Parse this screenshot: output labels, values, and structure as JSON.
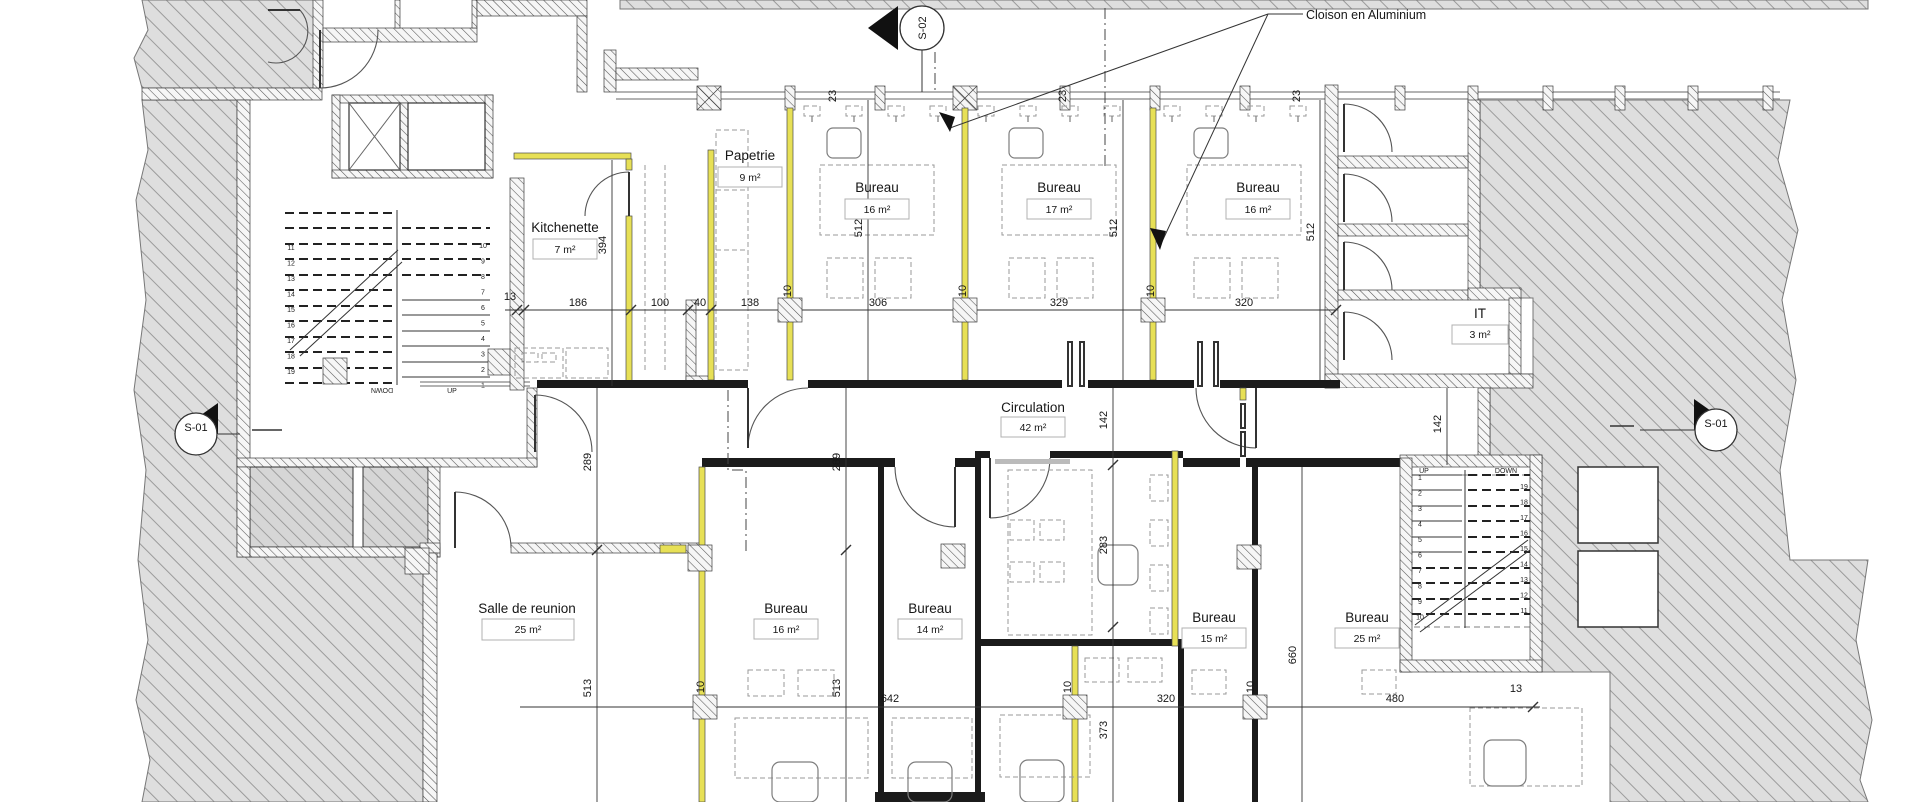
{
  "callout": {
    "text": "Cloison en Aluminium"
  },
  "markers": {
    "s02": "S-02",
    "s01_left": "S-01",
    "s01_right": "S-01"
  },
  "rooms": {
    "papetrie": {
      "name": "Papetrie",
      "area": "9 m²"
    },
    "kitchenette": {
      "name": "Kitchenette",
      "area": "7 m²"
    },
    "bureau_t1": {
      "name": "Bureau",
      "area": "16 m²"
    },
    "bureau_t2": {
      "name": "Bureau",
      "area": "17 m²"
    },
    "bureau_t3": {
      "name": "Bureau",
      "area": "16 m²"
    },
    "it": {
      "name": "IT",
      "area": "3 m²"
    },
    "circulation": {
      "name": "Circulation",
      "area": "42 m²"
    },
    "salle": {
      "name": "Salle de reunion",
      "area": "25 m²"
    },
    "bureau_b1": {
      "name": "Bureau",
      "area": "16 m²"
    },
    "bureau_b2": {
      "name": "Bureau",
      "area": "14 m²"
    },
    "bureau_b3": {
      "name": "Bureau",
      "area": "15 m²"
    },
    "bureau_b4": {
      "name": "Bureau",
      "area": "25 m²"
    }
  },
  "dims": {
    "top": [
      "13",
      "186",
      "100",
      "40",
      "138",
      "306",
      "329",
      "320"
    ],
    "glazing_offsets": [
      "23",
      "23",
      "23"
    ],
    "thickness": [
      "10",
      "10",
      "10",
      "10",
      "10",
      "10"
    ],
    "verticals": {
      "v394": "394",
      "v512a": "512",
      "v512b": "512",
      "v512c": "512",
      "v289a": "289",
      "v289b": "289",
      "v513a": "513",
      "v513b": "513",
      "v142a": "142",
      "v142b": "142",
      "v283": "283",
      "v373": "373",
      "v660": "660"
    },
    "bottom": [
      "642",
      "320",
      "480"
    ],
    "b13": "13"
  },
  "stairs": {
    "up": "UP",
    "down": "DOWN",
    "left": {
      "col_a": [
        "11",
        "12",
        "13",
        "14",
        "15",
        "16",
        "17",
        "18",
        "19"
      ],
      "col_b": [
        "10",
        "9",
        "8",
        "7",
        "6",
        "5",
        "4",
        "3",
        "2",
        "1"
      ]
    },
    "right": {
      "col_a": [
        "1",
        "2",
        "3",
        "4",
        "5",
        "6",
        "7",
        "8",
        "9",
        "10"
      ],
      "col_b": [
        "19",
        "18",
        "17",
        "16",
        "15",
        "14",
        "13",
        "12",
        "11"
      ]
    }
  }
}
